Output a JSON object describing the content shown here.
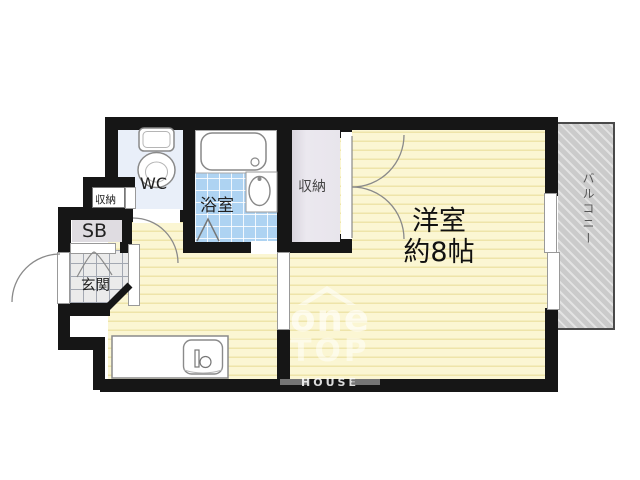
{
  "floorplan": {
    "labels": {
      "wc": "WC",
      "bathroom": "浴室",
      "storage_small": "収納",
      "shoe_box": "SB",
      "entrance": "玄関",
      "storage_main": "収納",
      "western_room_line1": "洋室",
      "western_room_line2": "約8帖",
      "balcony": "バルコニー"
    },
    "watermark": {
      "brand_top": "one",
      "brand_bottom": "TOP",
      "brand_sub": "HOUSE"
    },
    "colors": {
      "wall": "#161616",
      "room_floor": "#fbf6d3",
      "room_floor_stripe": "#eee4a9",
      "bath_tile": "#aed3f2",
      "wc_floor": "#e9eff9",
      "closet_floor": "#e8e5ec",
      "entrance_tile": "#ebebeb",
      "balcony": "#cbcbcb"
    }
  }
}
